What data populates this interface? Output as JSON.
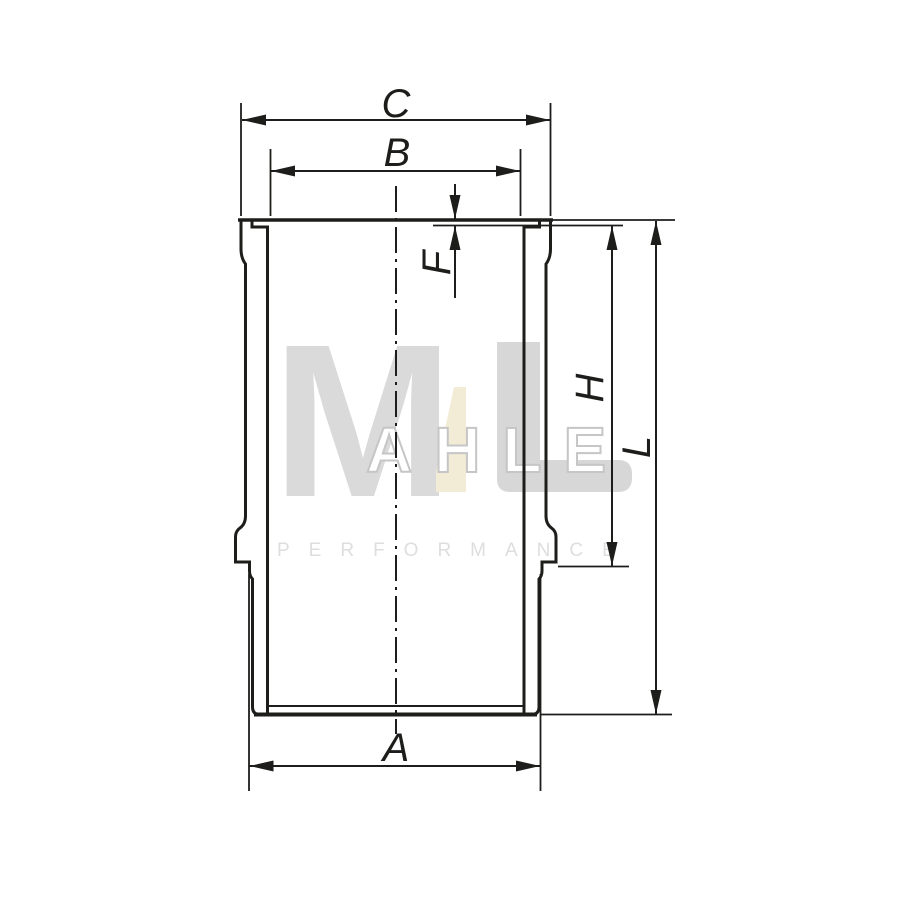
{
  "drawing": {
    "labels": {
      "top_outer_width": "C",
      "bore_width": "B",
      "flange_recess_depth": "F",
      "upper_section_height": "H",
      "total_length": "L",
      "bottom_outer_width": "A"
    }
  },
  "watermark": {
    "brand_initial": "M",
    "brand_outline_letters": "AHLE",
    "tagline": "PERFORMANCE"
  },
  "colors": {
    "line": "#1d1d1b",
    "watermark_gray": "#dadada",
    "watermark_beige": "#f2ebd6",
    "background": "#ffffff"
  }
}
